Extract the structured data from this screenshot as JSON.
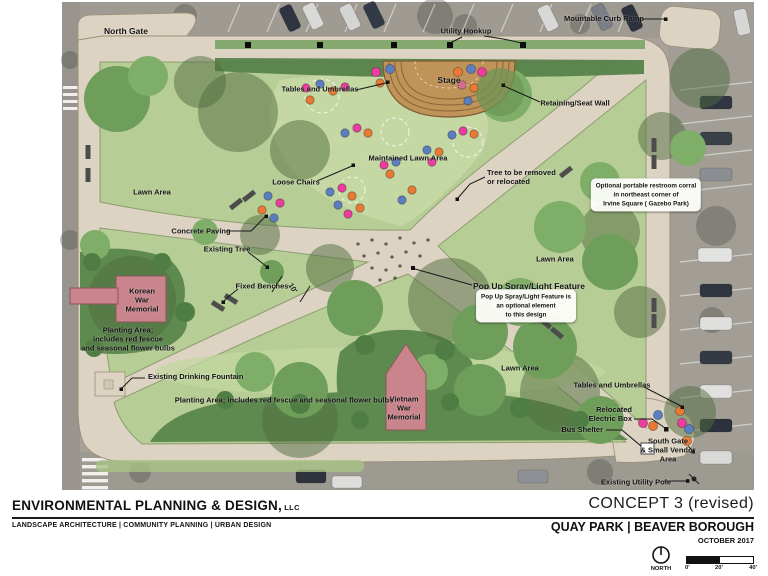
{
  "plan": {
    "labels": {
      "north_gate": "North Gate",
      "utility_hookup": "Utility Hookup",
      "mountable_curb_ramp": "Mountable Curb Ramp",
      "stage": "Stage",
      "tables_and_umbrellas_north": "Tables and Umbrellas",
      "retaining_seat_wall": "Retaining/Seat Wall",
      "maintained_lawn_area": "Maintained Lawn Area",
      "loose_chairs": "Loose Chairs",
      "tree_to_be_removed": "Tree to be removed\nor relocated",
      "lawn_area_west": "Lawn Area",
      "restroom_note": "Optional portable restroom corral\nin northeast corner of\nIrvine Square ( Gazebo Park)",
      "concrete_paving": "Concrete Paving",
      "existing_tree": "Existing Tree",
      "fixed_benches": "Fixed Benches",
      "path_width": "10'",
      "korean_war_memorial": "Korean\nWar\nMemorial",
      "planting_area_west": "Planting Area;\nincludes red fescue\nand seasonal flower bulbs",
      "existing_drinking_fountain": "Existing Drinking Fountain",
      "planting_area_south": "Planting Area; includes red fescue and seasonal flower bulbs",
      "vietnam_war_memorial": "Vietnam\nWar\nMemorial",
      "lawn_area_south": "Lawn Area",
      "lawn_area_east": "Lawn Area",
      "pop_up_feature": "Pop Up Spray/Light Feature",
      "pop_up_note": "Pop Up Spray/Light Feature is\nan optional element\nto this design",
      "tables_and_umbrellas_south": "Tables and Umbrellas",
      "relocated_electric_box": "Relocated\nElectric Box",
      "bus_shelter": "Bus Shelter",
      "south_gate": "South Gate\n& Small Vendor\nArea",
      "existing_utility_pole": "Existing Utility Pole"
    },
    "legend_colors": {
      "path_tan": "#ddd3c2",
      "lawn_green": "#b7cd96",
      "maintained_lawn_green": "#c8dba6",
      "planting_green": "#5e8a50",
      "memorial_pink": "#c9858b",
      "stage_tan": "#c09358",
      "chair_orange": "#e87a33",
      "chair_blue": "#5b7ec0",
      "chair_magenta": "#ea3d9e"
    }
  },
  "title_block": {
    "firm_name": "ENVIRONMENTAL PLANNING & DESIGN,",
    "firm_suffix": " LLC",
    "firm_tagline": "LANDSCAPE ARCHITECTURE | COMMUNITY PLANNING | URBAN DESIGN",
    "concept": "CONCEPT 3 (revised)",
    "project": "QUAY PARK | BEAVER BOROUGH",
    "date": "OCTOBER 2017",
    "north_label": "NORTH",
    "scale_ticks": [
      "0'",
      "20'",
      "40'"
    ]
  }
}
